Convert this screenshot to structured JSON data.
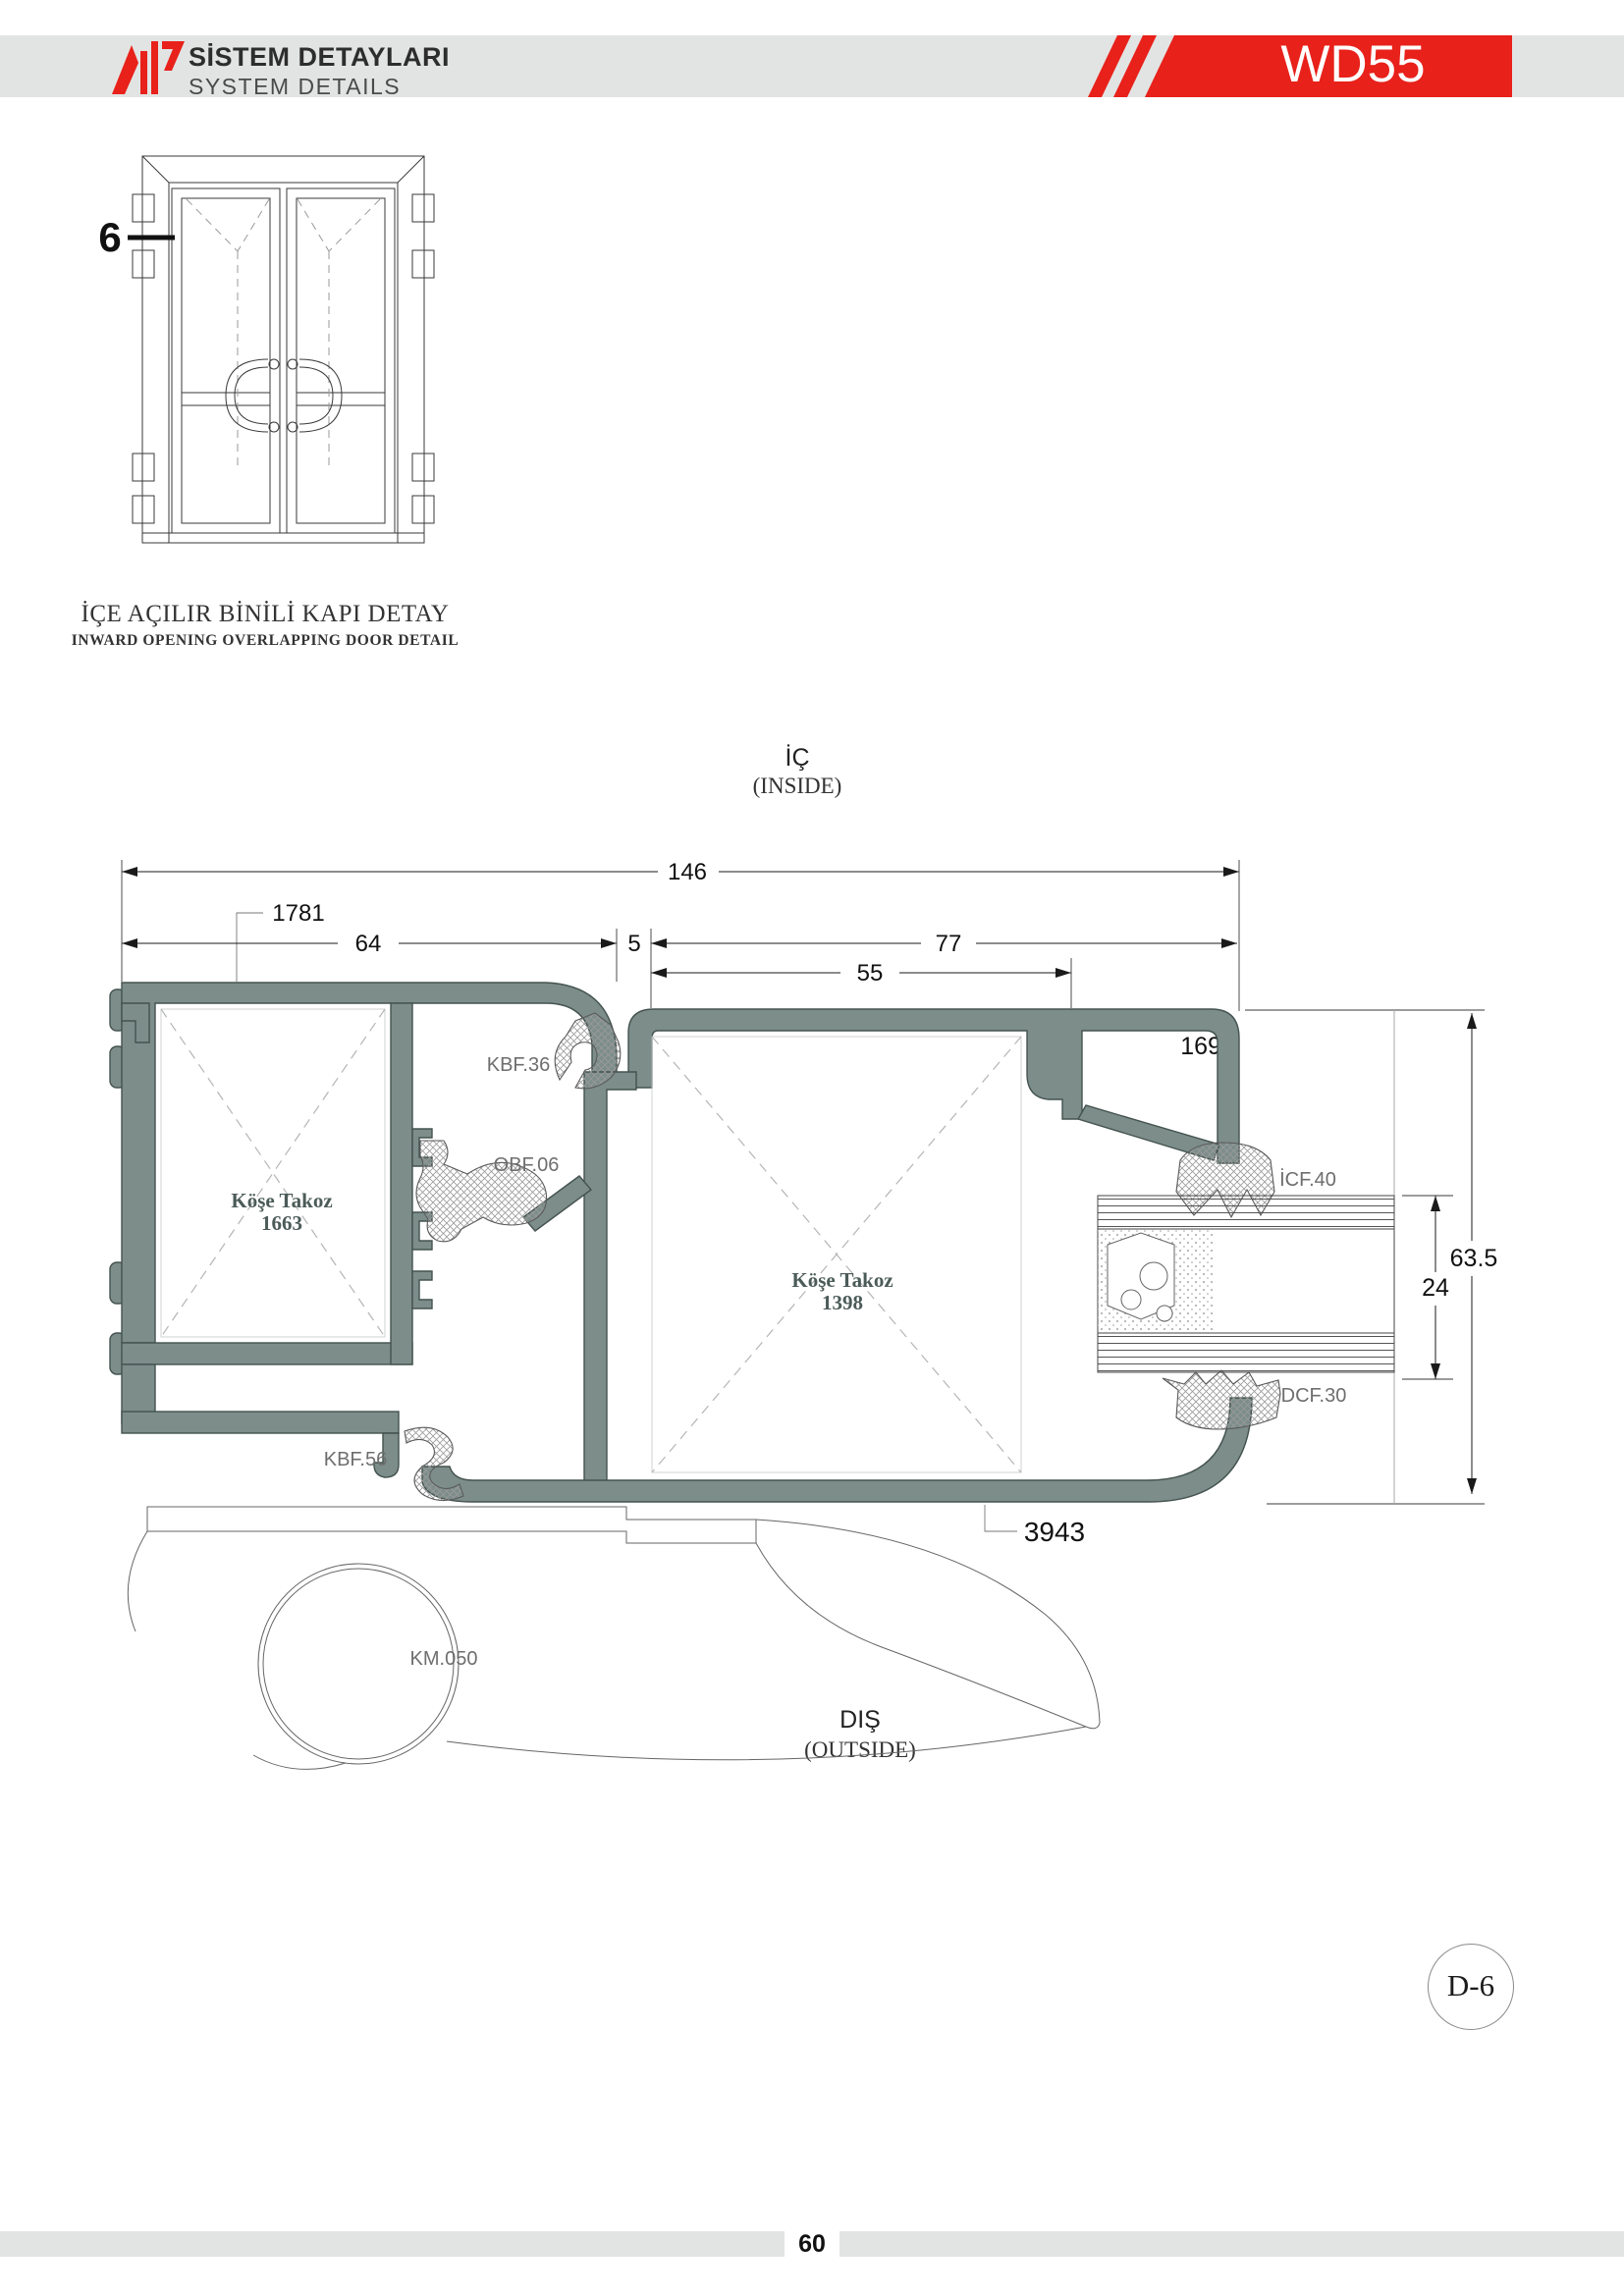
{
  "header": {
    "title_tr": "SİSTEM DETAYLARI",
    "title_en": "SYSTEM DETAILS",
    "product_code": "WD55"
  },
  "elevation": {
    "callout": "6",
    "caption_tr": "İÇE AÇILIR BİNİLİ KAPI DETAY",
    "caption_en": "INWARD OPENING OVERLAPPING DOOR DETAIL"
  },
  "section": {
    "inside_tr": "İÇ",
    "inside_en": "(INSIDE)",
    "outside_tr": "DIŞ",
    "outside_en": "(OUTSIDE)",
    "dims": {
      "total_depth": "146",
      "frame_depth": "64",
      "gap": "5",
      "sash_depth": "77",
      "chamber": "55",
      "panel_height": "63.5",
      "panel_thickness": "24"
    },
    "profile_codes": {
      "outer_frame": "1781",
      "sash": "1699",
      "bottom_sash": "3943"
    },
    "parts": {
      "kbf36": "KBF.36",
      "obf06": "OBF.06",
      "kbf56": "KBF.56",
      "icf40": "İCF.40",
      "dcf30": "DCF.30",
      "km050": "KM.050"
    },
    "corner_block_left": {
      "name": "Köşe Takoz",
      "code": "1663"
    },
    "corner_block_right": {
      "name": "Köşe Takoz",
      "code": "1398"
    }
  },
  "footer": {
    "page": "60",
    "detail_ref": "D-6"
  },
  "colors": {
    "accent_red": "#e8211a",
    "profile_fill": "#7c8d8a",
    "profile_stroke": "#44534f",
    "header_bar": "#e2e4e3"
  }
}
